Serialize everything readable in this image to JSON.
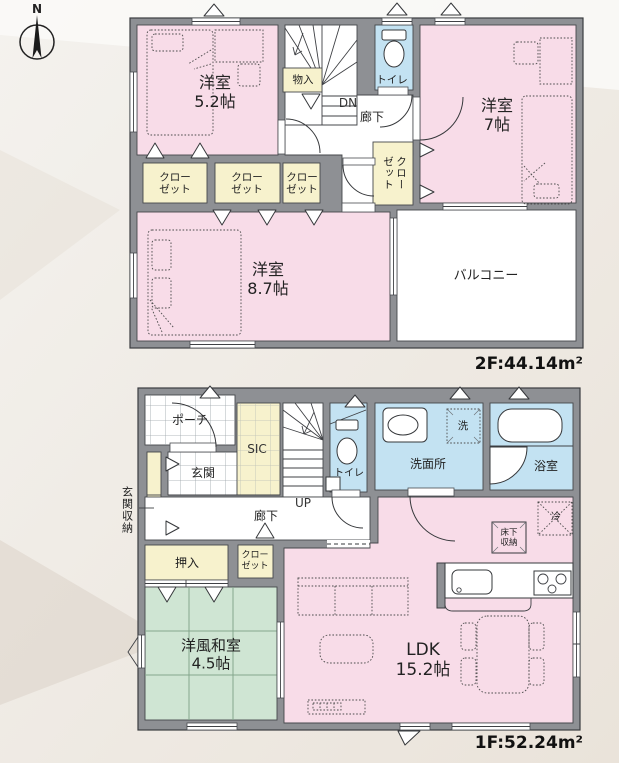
{
  "compass": {
    "north": "N"
  },
  "floor2": {
    "area_label": "2F:44.14m²",
    "rooms": {
      "bedroom52": "洋室\n5.2帖",
      "bedroom7": "洋室\n7帖",
      "bedroom87": "洋室\n8.7帖",
      "balcony": "バルコニー",
      "storage": "物入",
      "toilet": "トイレ",
      "down": "DN",
      "hallway": "廊下",
      "closet1": "クロー\nゼット",
      "closet2": "クロー\nゼット",
      "closet3": "クロー\nゼット",
      "closet_vertical": "クローゼット"
    }
  },
  "floor1": {
    "area_label": "1F:52.24m²",
    "rooms": {
      "porch": "ポーチ",
      "genkan": "玄関",
      "sic": "SIC",
      "up": "UP",
      "toilet": "トイレ",
      "washroom": "洗面所",
      "washer": "洗",
      "bath": "浴室",
      "entrance_storage": "玄関収納",
      "hallway": "廊下",
      "oshiire": "押入",
      "closet": "クロー\nゼット",
      "tatami": "洋風和室\n4.5帖",
      "ldk": "LDK\n15.2帖",
      "fridge": "冷",
      "floor_storage": "床下\n収納"
    }
  },
  "colors": {
    "room_pink": "#f8dce8",
    "room_yellow": "#f7f2cd",
    "room_blue": "#c3e2f2",
    "room_green": "#cfe5d3",
    "wall_gray": "#8e9094",
    "tatami_line": "#84a68c"
  }
}
